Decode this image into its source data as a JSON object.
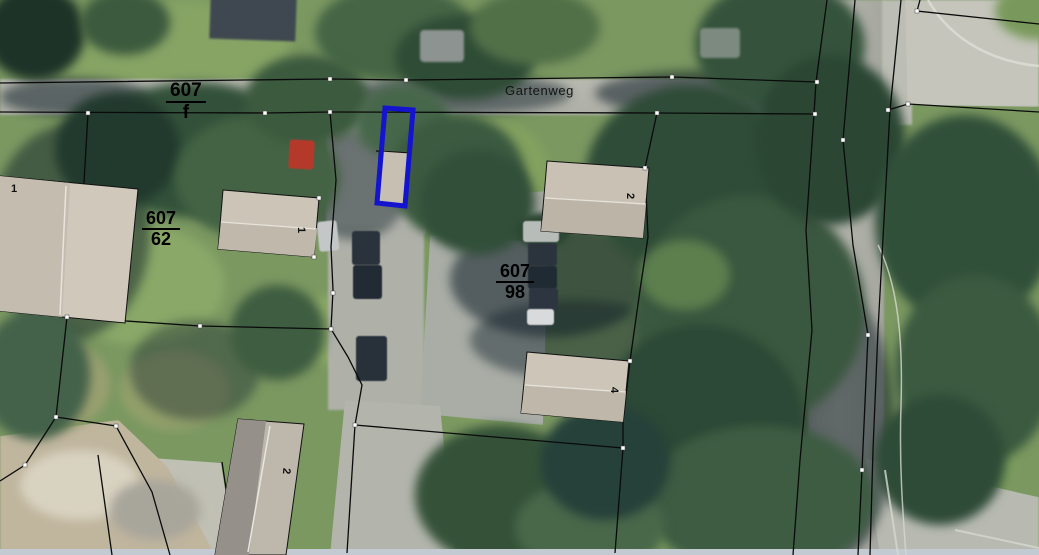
{
  "map": {
    "street": {
      "label": "Gartenweg"
    },
    "parcel_labels": {
      "f": {
        "numerator": "607",
        "denominator": "f"
      },
      "p62": {
        "numerator": "607",
        "denominator": "62"
      },
      "p98": {
        "numerator": "607",
        "denominator": "98"
      }
    },
    "house_numbers": {
      "left_house": "1",
      "house_62": "1",
      "house_top": "2",
      "house_4": "4",
      "house_bottom": "2"
    },
    "highlight": {
      "name": "selected parcel",
      "color": "#1414cf"
    },
    "colors": {
      "boundary_line": "#0a0a0a",
      "vertex_marker": "#ffffff"
    }
  }
}
